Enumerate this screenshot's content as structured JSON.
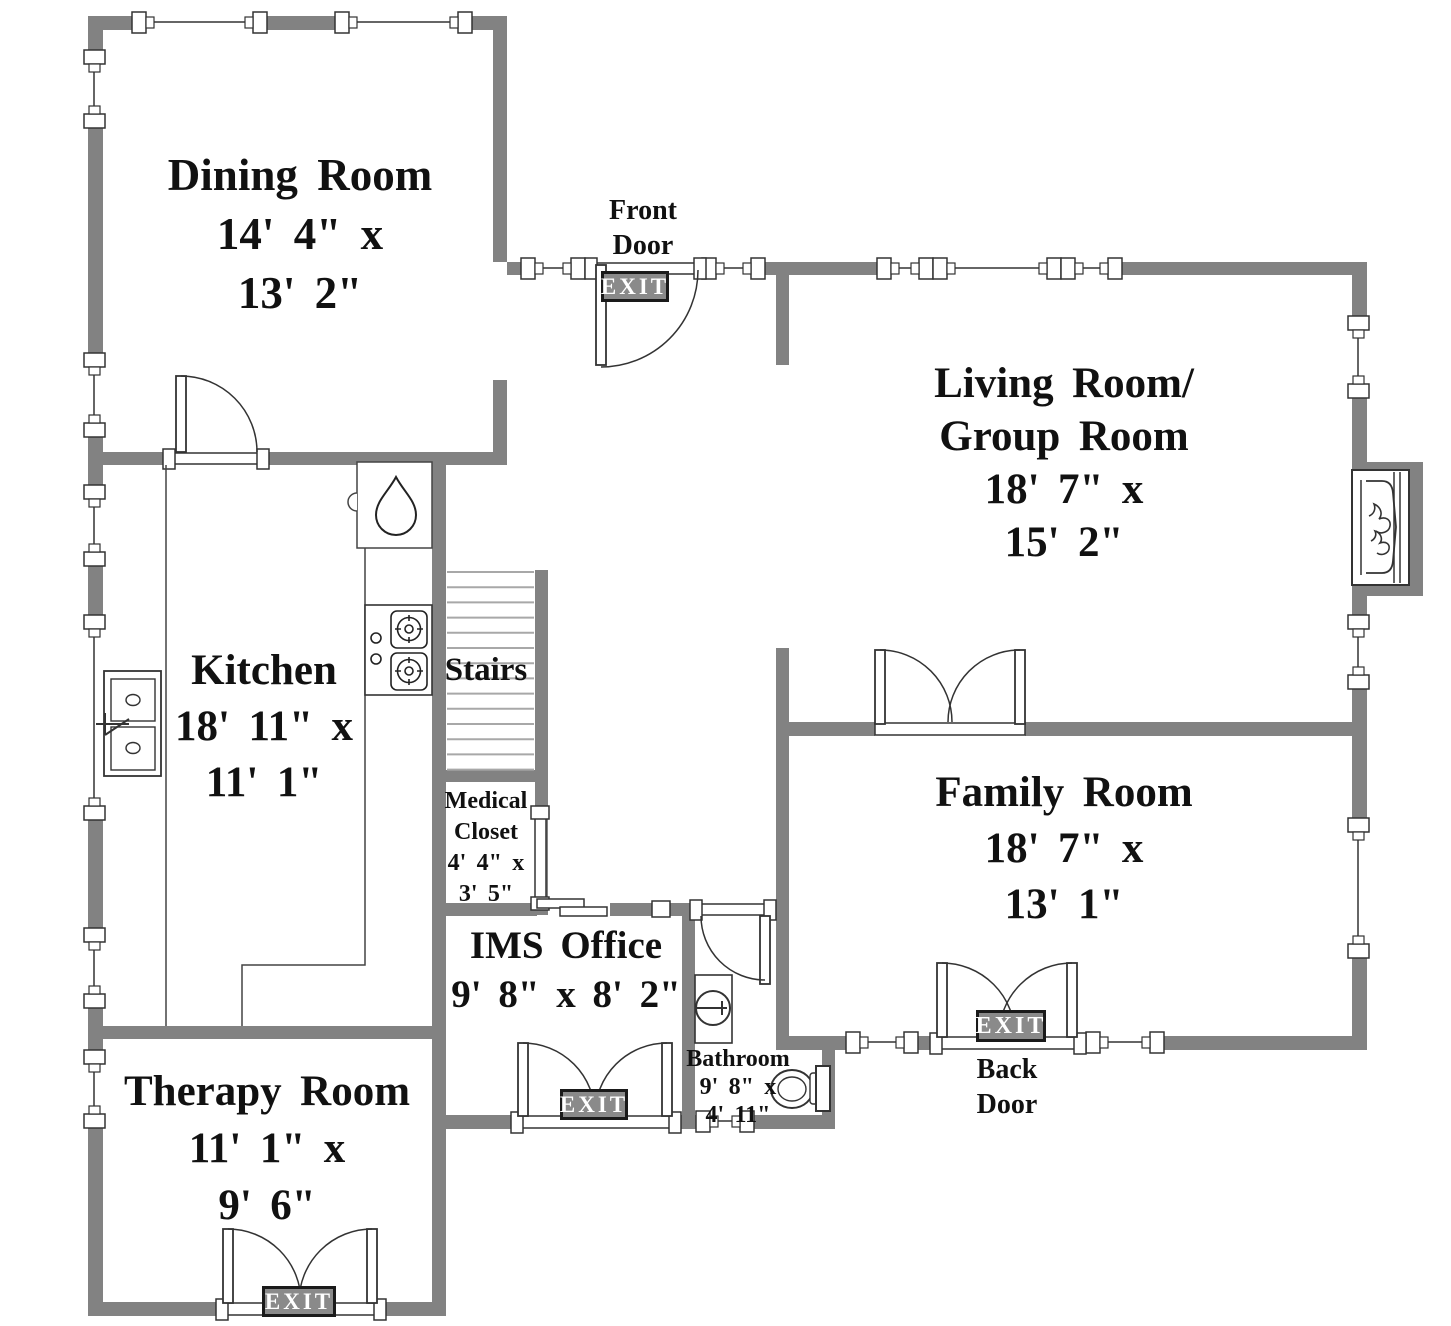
{
  "rooms": {
    "dining": {
      "lines": [
        "Dining Room",
        "14' 4\" x",
        "13' 2\""
      ]
    },
    "living": {
      "lines": [
        "Living Room/",
        "Group Room",
        "18' 7\" x",
        "15' 2\""
      ]
    },
    "kitchen": {
      "lines": [
        "Kitchen",
        "18' 11\" x",
        "11' 1\""
      ]
    },
    "stairs": {
      "lines": [
        "Stairs"
      ]
    },
    "medical_closet": {
      "lines": [
        "Medical",
        "Closet",
        "4' 4\" x",
        "3' 5\""
      ]
    },
    "ims_office": {
      "lines": [
        "IMS Office",
        "9' 8\" x 8' 2\""
      ]
    },
    "bathroom": {
      "lines": [
        "Bathroom",
        "9' 8\" x",
        "4' 11\""
      ]
    },
    "family": {
      "lines": [
        "Family Room",
        "18' 7\" x",
        "13' 1\""
      ]
    },
    "therapy": {
      "lines": [
        "Therapy Room",
        "11' 1\" x",
        "9' 6\""
      ]
    }
  },
  "doors": {
    "front": {
      "lines": [
        "Front",
        "Door"
      ]
    },
    "back": {
      "lines": [
        "Back",
        "Door"
      ]
    }
  },
  "exit_sign": "EXIT",
  "colors": {
    "wall": "#828282",
    "exit_bg": "#8a8a8a",
    "tread": "#a8a8a8"
  }
}
